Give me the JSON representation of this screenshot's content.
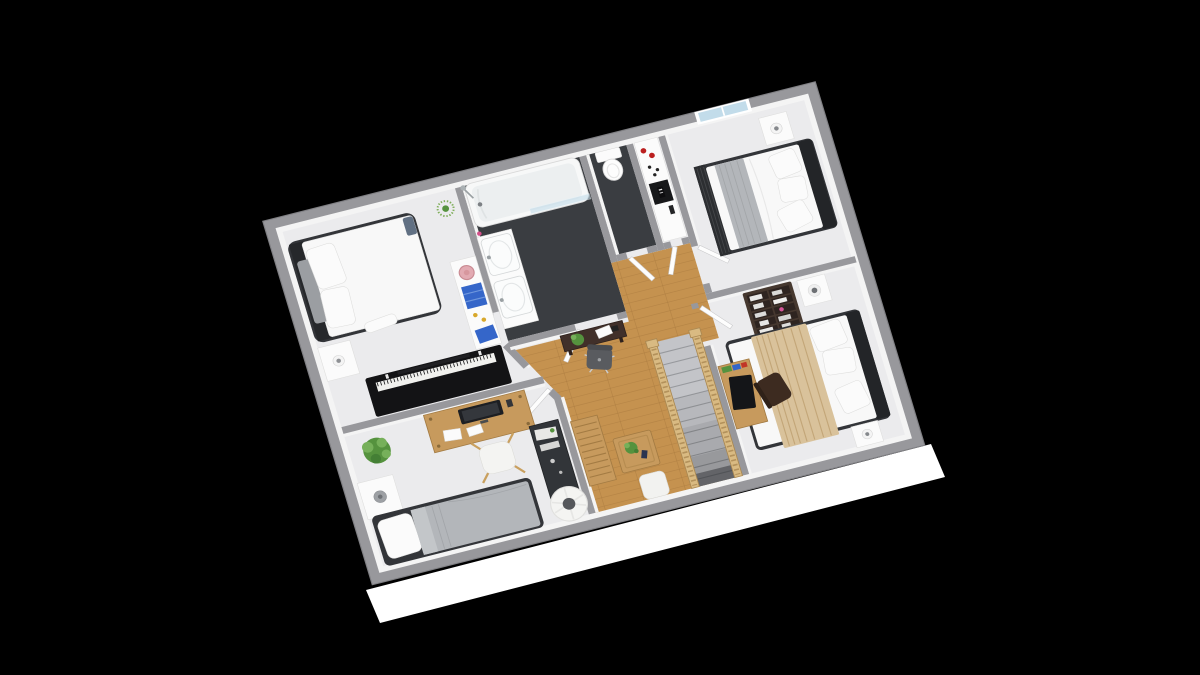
{
  "scene": {
    "title": "3D isometric floor plan render of an upper storey with four bedrooms, bathroom, WC and a landing with staircase, on a black background",
    "rooms": [
      {
        "name": "bedroom-northwest",
        "floor": "light gray carpet",
        "furniture": [
          "double bed with dark frame and white duvet",
          "white nightstand with lamp",
          "black upright piano",
          "white storage shelf with blue books, pink plate and yellow pots",
          "spider plant on stand"
        ]
      },
      {
        "name": "bathroom",
        "floor": "dark tile",
        "furniture": [
          "bathtub with faucet",
          "glass shower screen",
          "wall shower head",
          "double sink vanity",
          "pink soap dispenser"
        ]
      },
      {
        "name": "wc",
        "floor": "dark tile",
        "furniture": [
          "toilet with tank"
        ]
      },
      {
        "name": "vestibule",
        "floor": "light gray carpet",
        "furniture": [
          "white cabinet with red candles, black tray with label and remote"
        ]
      },
      {
        "name": "bedroom-northeast",
        "floor": "light gray carpet",
        "furniture": [
          "window in north wall",
          "double bed with dark headboard, slatted footboard and gray throw",
          "white nightstand with lamp"
        ]
      },
      {
        "name": "bedroom-east",
        "floor": "light gray carpet",
        "furniture": [
          "dark bookshelf with white books",
          "two white nightstands with lamps",
          "double bed with tan throw blanket",
          "wooden desk with black monitor and colored books",
          "dark desk chair"
        ]
      },
      {
        "name": "bedroom-southwest",
        "floor": "light gray carpet",
        "furniture": [
          "wooden desk with monitor and papers",
          "white stool chair",
          "potted plant",
          "white nightstand with gray lamp",
          "bed with gray duvet and white pillow",
          "dark sideboard",
          "round floor lamp"
        ]
      },
      {
        "name": "landing",
        "floor": "oak wood planks",
        "furniture": [
          "dark console table with plant and papers",
          "gray office chair with star base",
          "slatted wooden bench",
          "wooden coffee table with plant",
          "white hall chair",
          "carpeted staircase with wooden balustrades"
        ]
      }
    ],
    "colors": {
      "bg": "#000000",
      "wall": "#98989c",
      "wallEdge": "#7f7f83",
      "wallFace": "#f4f4f4",
      "floorRoom": "#ebebed",
      "floorDark": "#3a3d41",
      "wood": "#c5924f",
      "woodLine": "#a97a3f",
      "exterior": "#ffffff",
      "white": "#fbfbfb",
      "whiteEdge": "#dededd",
      "frameDark": "#333539",
      "headboard": "#232528",
      "duvet": "#f8f8f8",
      "grayBlanket": "#b3b6ba",
      "tanBlanket": "#d9c29b",
      "tanLine": "#c3a678",
      "piano": "#131315",
      "keys": "#f1f1ee",
      "woodFurn": "#c79a5d",
      "woodFurnEdge": "#a37b43",
      "shelfDark": "#46382f",
      "sideboard": "#323539",
      "green": "#55923e",
      "greenLight": "#76b05a",
      "red": "#bb1f1f",
      "blue": "#3566c9",
      "yellow": "#d8a82c",
      "pink": "#e2aab2",
      "glass": "#c2dcea",
      "rail": "#d9ba82",
      "railEdge": "#aa8852",
      "step": "#c3c4c8",
      "stepLine": "#97999d",
      "lampGray": "#9da0a4"
    }
  }
}
